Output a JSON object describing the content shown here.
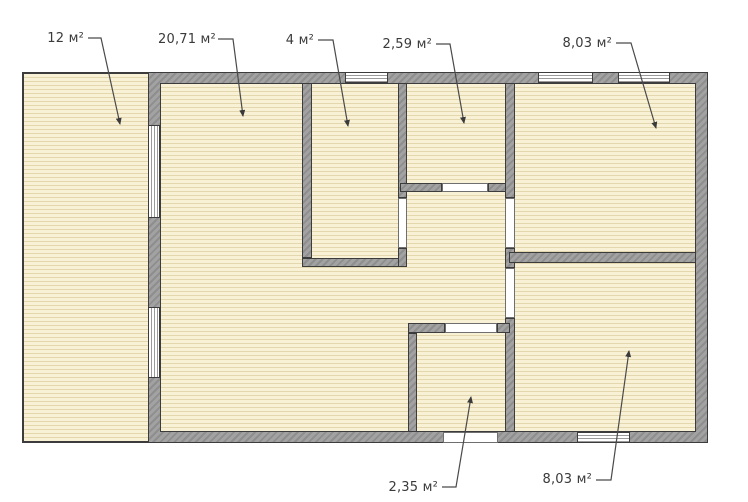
{
  "title": "Floor plan",
  "rooms": [
    {
      "id": "veranda",
      "label": "12 м²"
    },
    {
      "id": "living-room",
      "label": "20,71 м²"
    },
    {
      "id": "small-room-top",
      "label": "4 м²"
    },
    {
      "id": "closet-top",
      "label": "2,59 м²"
    },
    {
      "id": "room-top-right",
      "label": "8,03 м²"
    },
    {
      "id": "entry-bottom",
      "label": "2,35 м²"
    },
    {
      "id": "room-bottom-right",
      "label": "8,03 м²"
    }
  ],
  "colors": {
    "background": "#ffffff",
    "floor": "#f8f1d6",
    "floor_stripe": "#e3d7ae",
    "wall": "#a2a2a2",
    "wall_hatch": "#8e8e8e",
    "outline": "#3c3c3c",
    "label_text": "#3a3a3a"
  }
}
